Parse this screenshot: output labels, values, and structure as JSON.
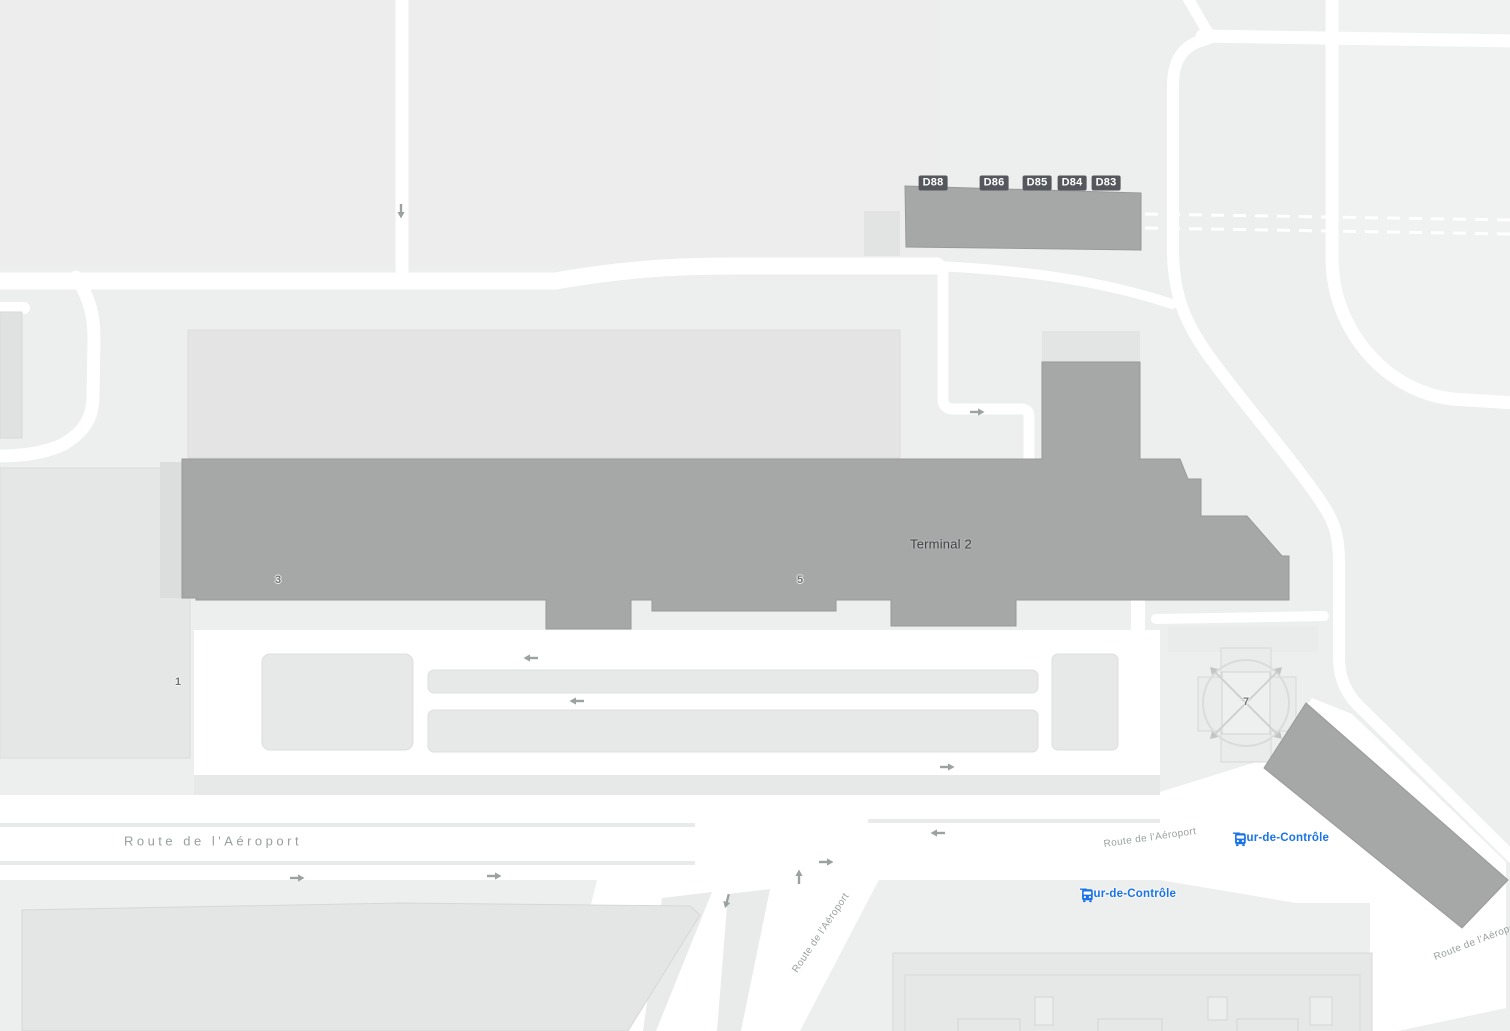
{
  "map": {
    "terminal": {
      "label": "Terminal 2"
    },
    "gates": [
      "D88",
      "D86",
      "D85",
      "D84",
      "D83"
    ],
    "building_numbers": {
      "n1": "1",
      "n3": "3",
      "n5": "5",
      "n7": "7"
    },
    "road_labels": {
      "route_de_l_aeroport": "Route de l'Aéroport"
    },
    "transit_stops": {
      "tour_de_controle": "Tour-de-Contrôle"
    },
    "icons": {
      "bus": "bus-icon",
      "one_way": "one-way-arrow-icon"
    },
    "colors": {
      "land": "#edeeee",
      "road": "#ffffff",
      "building_dark": "#a6a7a7",
      "building_light": "#e5e6e6",
      "gate_badge_bg": "#54585c",
      "gate_badge_text": "#ffffff",
      "road_label_text": "#9aa09f",
      "transit_blue": "#1a73e8"
    }
  }
}
